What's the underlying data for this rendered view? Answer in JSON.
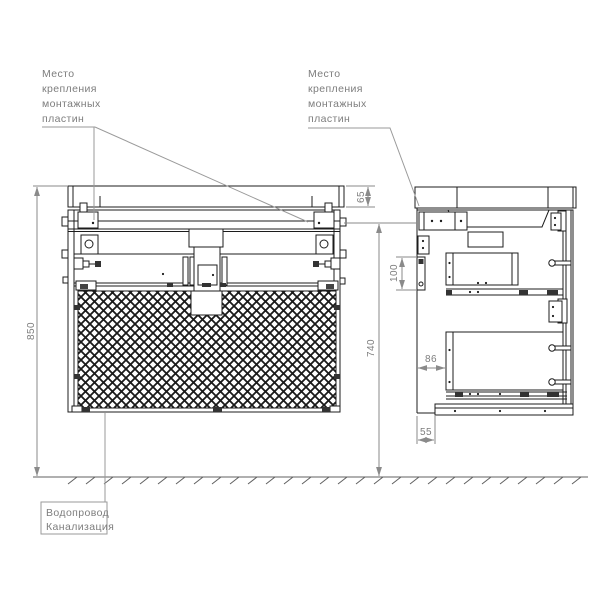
{
  "page": {
    "background": "#ffffff",
    "kind": "technical installation drawing"
  },
  "labels": {
    "mounting_plates_front": {
      "lines": [
        "Место",
        "крепления",
        "монтажных",
        "пластин"
      ]
    },
    "mounting_plates_side": {
      "lines": [
        "Место",
        "крепления",
        "монтажных",
        "пластин"
      ]
    },
    "utilities": {
      "lines": [
        "Водопровод",
        "Канализация"
      ]
    }
  },
  "dimensions": {
    "total_height_mm": "850",
    "worktop_height_mm": "65",
    "cabinet_height_mm": "740",
    "wall_bracket_height_mm": "100",
    "back_clearance_mm": "86",
    "bottom_recess_mm": "55"
  },
  "colors": {
    "outline": "#1c1c1c",
    "dimension": "#8a8a8a",
    "leader": "#9a9a9a",
    "text": "#7d7d7d",
    "ground": "#606060",
    "background": "#ffffff"
  }
}
